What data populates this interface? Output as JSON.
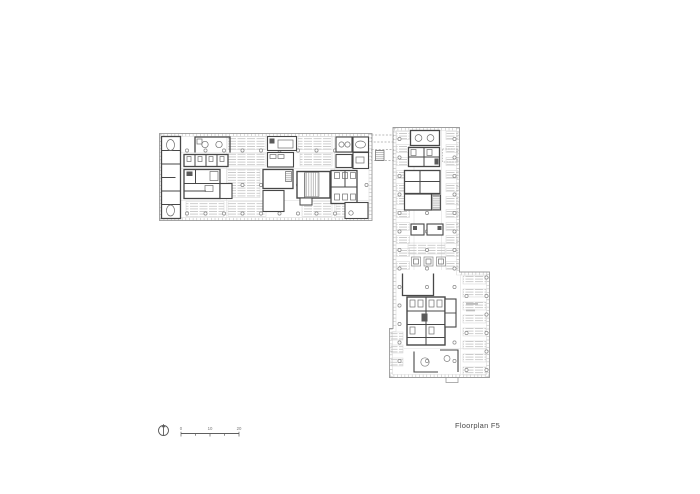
{
  "sheet": {
    "background": "#ffffff"
  },
  "title_block": {
    "label": "Floorplan F5"
  },
  "scale_bar": {
    "labels": [
      "0",
      "10",
      "20"
    ]
  },
  "north_arrow": {
    "icon": "north-arrow-icon"
  },
  "colors": {
    "walls": "#474747",
    "facade": "#9c9c9c",
    "furniture": "#c2c2c2",
    "fixtures": "#6e6e6e",
    "label_text": "#4a4a4a"
  }
}
